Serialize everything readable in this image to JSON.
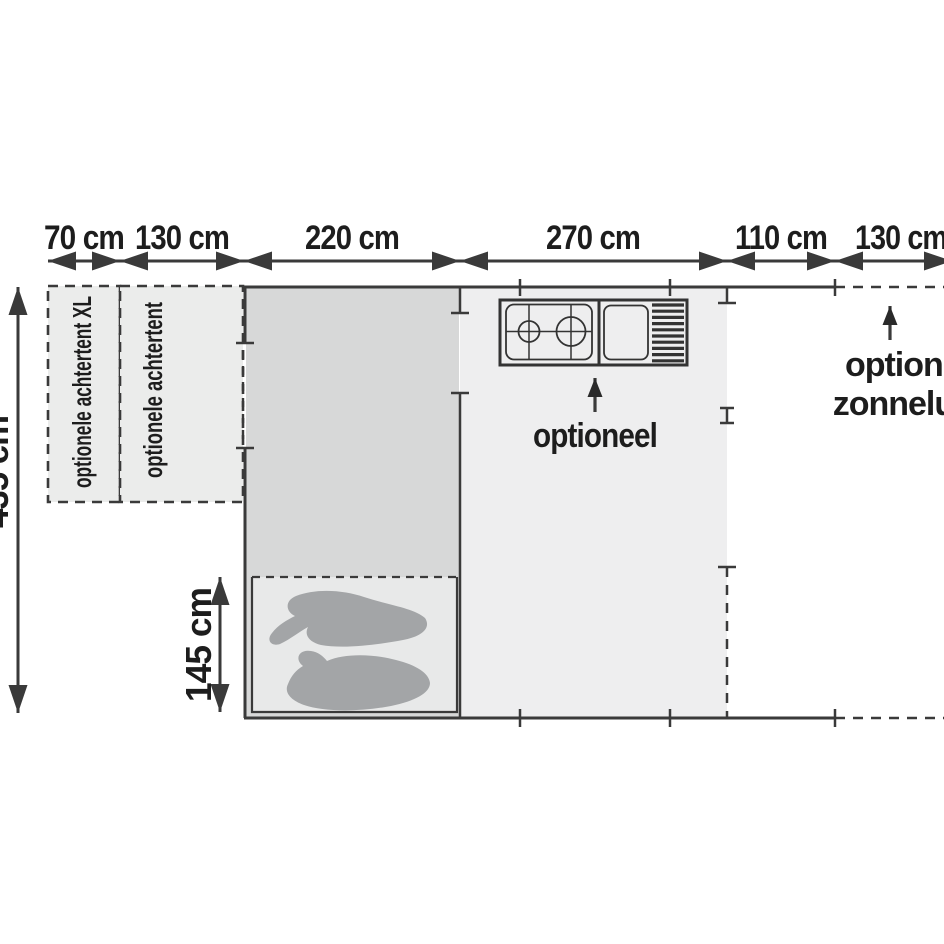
{
  "floorplan": {
    "top_dimensions": [
      "70 cm",
      "130 cm",
      "220 cm",
      "270 cm",
      "110 cm",
      "130 cm"
    ],
    "left_dimension": "435 cm",
    "bed_dimension": "145 cm",
    "labels": {
      "rear_tent_xl": "optionele achtertent XL",
      "rear_tent": "optionele achtertent",
      "kitchen_optional": "optioneel",
      "canopy_line1": "optionele",
      "canopy_line2": "zonneluifel"
    },
    "colors": {
      "background": "#ffffff",
      "line": "#3a3a3a",
      "text": "#1d1d1d",
      "trailer_fill": "#d7d8d8",
      "awning_fill": "#eeeeef",
      "rear_tent_fill": "#ebeceb",
      "bed_fill": "#e8e9e9",
      "sleeping_bag_fill": "#a3a5a7",
      "kitchen_fill": "#fbfbfb"
    }
  }
}
